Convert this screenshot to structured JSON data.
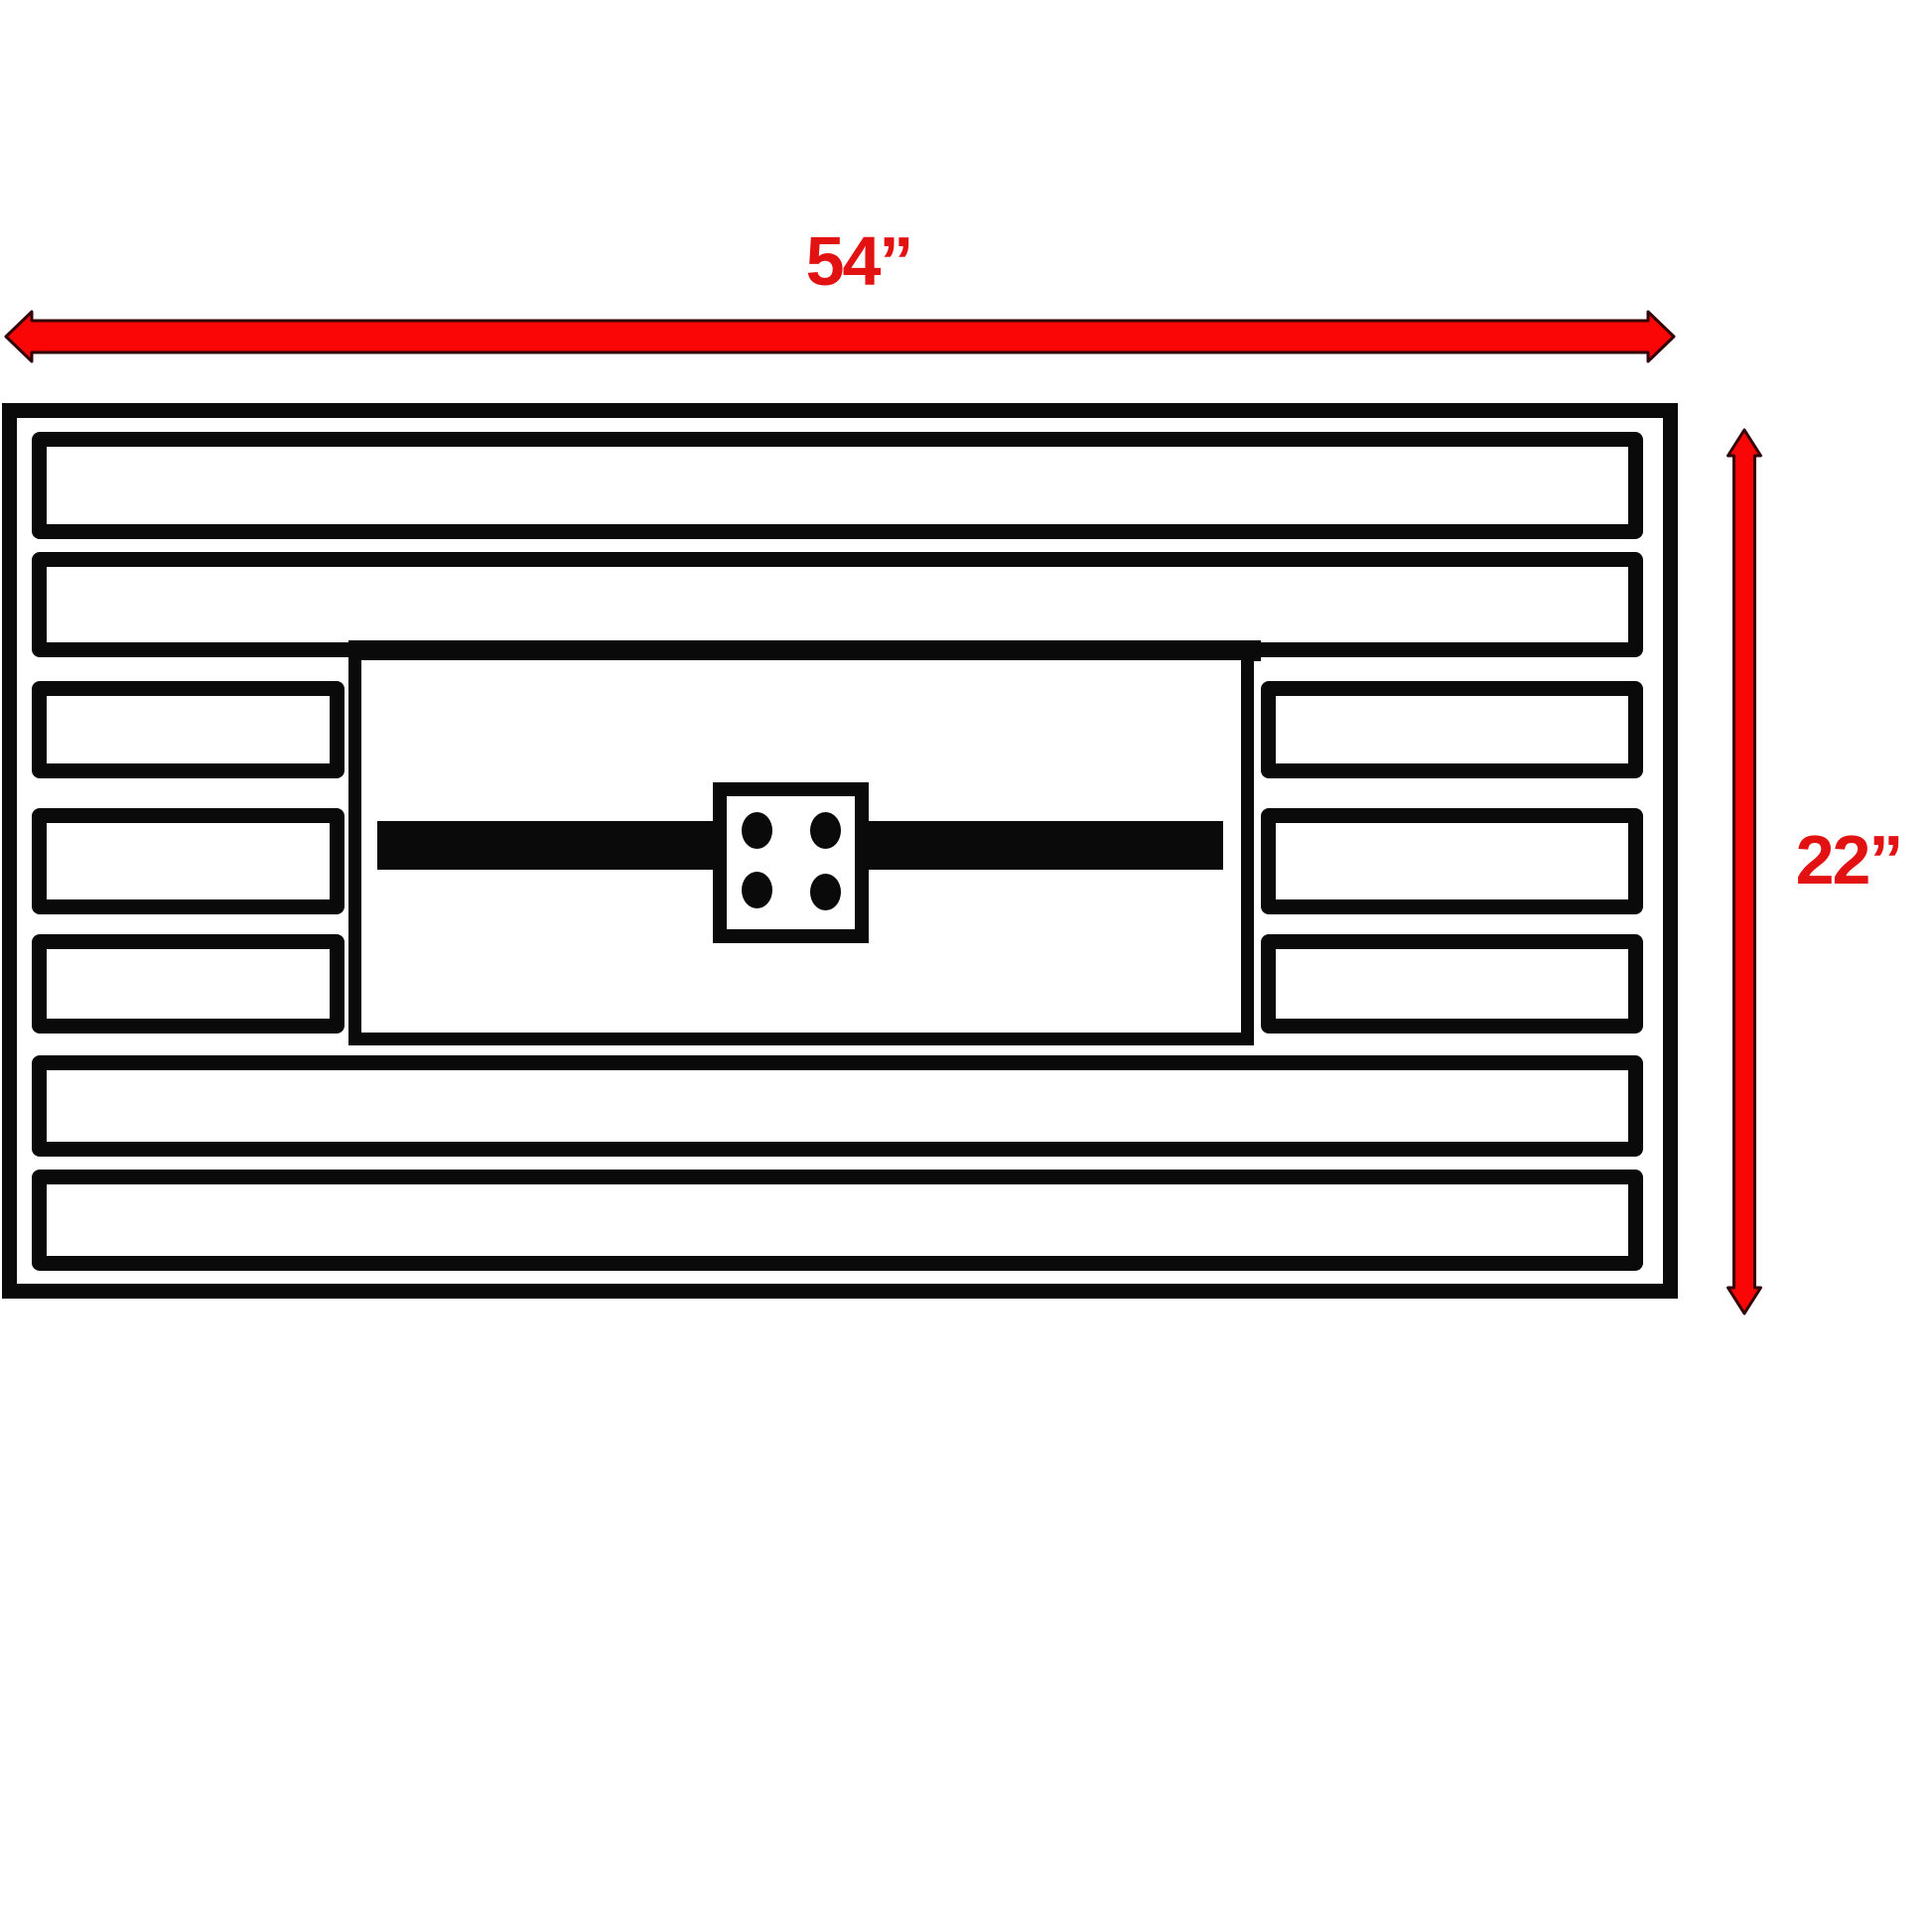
{
  "diagram": {
    "type": "dimension-drawing",
    "subject": "slatted rectangular table top with center burner panel, plan view",
    "width_label": "54”",
    "height_label": "22”",
    "width_value_inches": 54,
    "height_value_inches": 22,
    "units": "inches",
    "slat_row_count": 7,
    "full_width_slat_rows": [
      1,
      2,
      6,
      7
    ],
    "split_slat_rows": [
      3,
      4,
      5
    ],
    "burner_bolt_count": 4
  },
  "colors": {
    "dimension_red": "#fa0606",
    "dimension_text_red": "#e31212",
    "arrow_outline": "#330404",
    "line_black": "#0a0a0a",
    "background": "#ffffff"
  }
}
